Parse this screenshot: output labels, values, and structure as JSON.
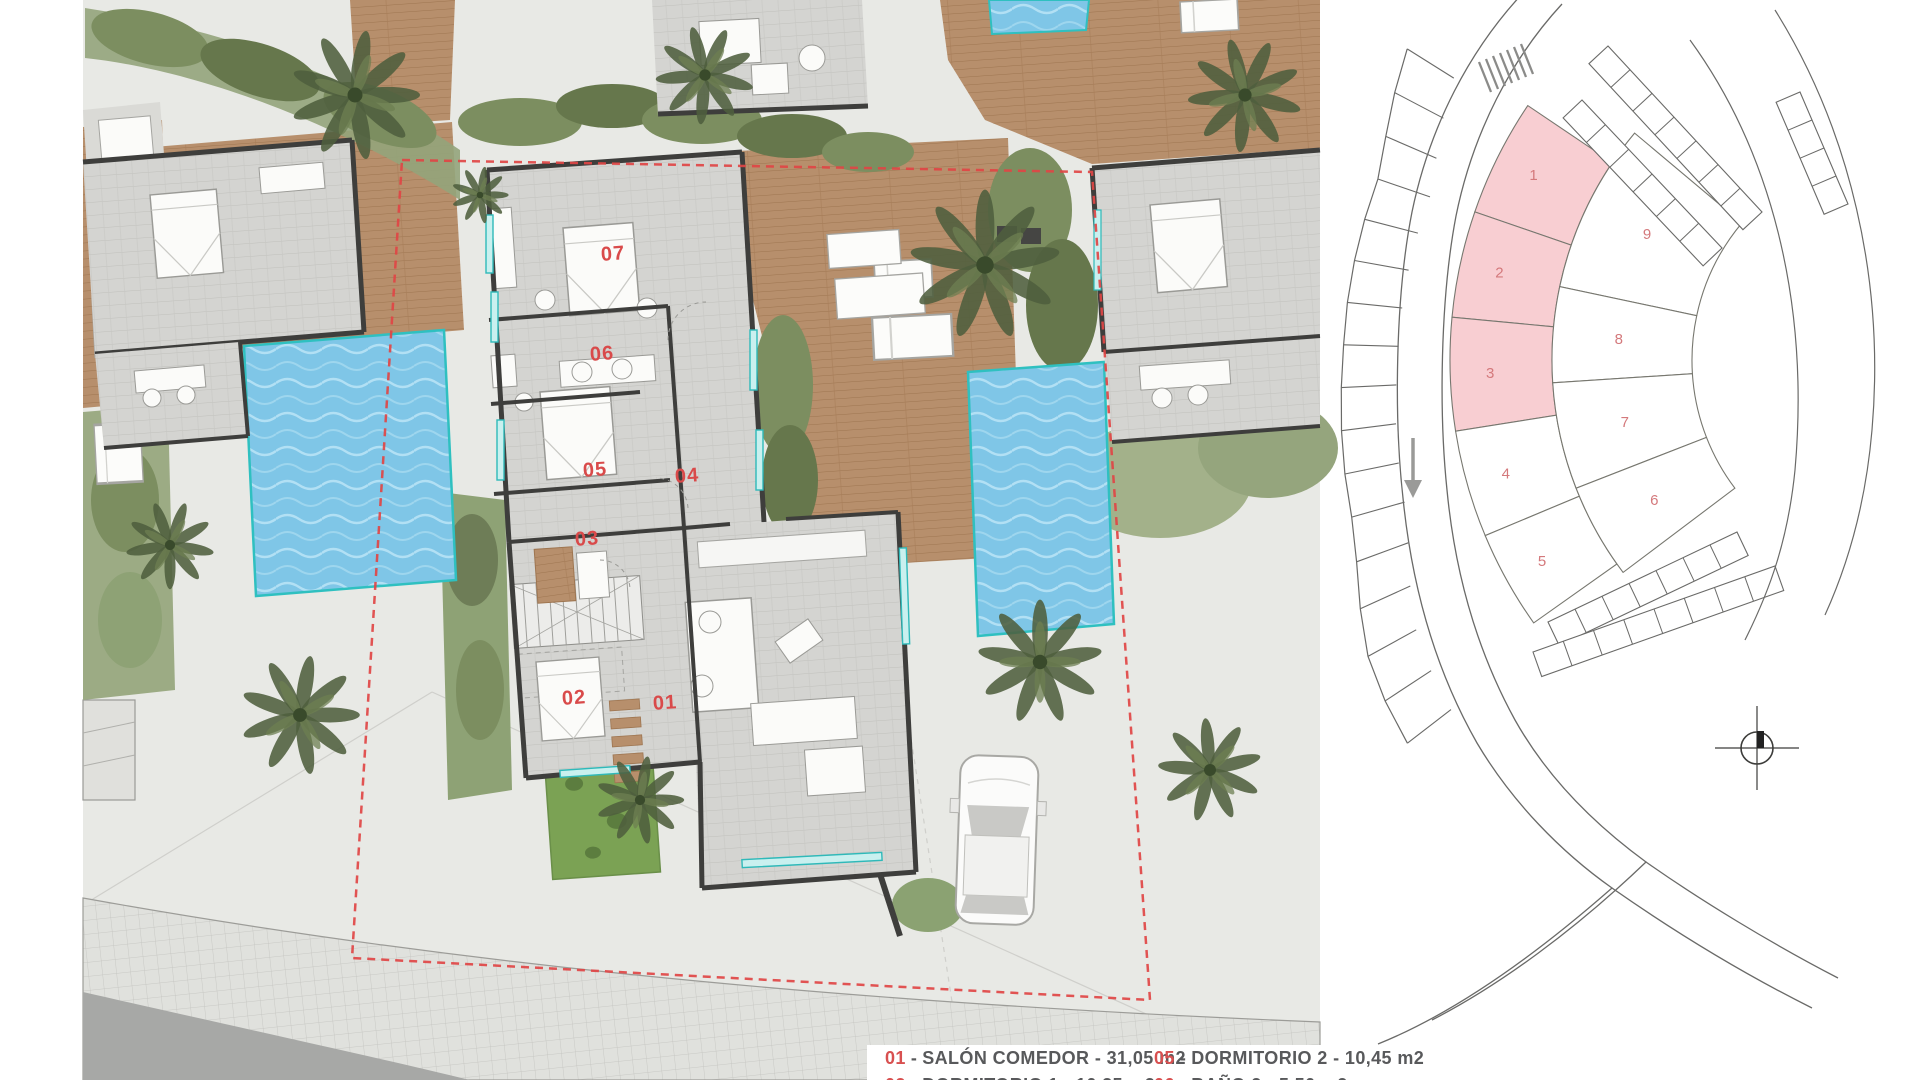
{
  "document": {
    "type": "architectural floor plan with key plan",
    "language": "Spanish"
  },
  "colors": {
    "pool_water": "#7fc6e7",
    "deck_wood": "#b78f6c",
    "walls": "#3e3e3c",
    "vegetation": "#8ea275",
    "plot_boundary_red": "#e04545",
    "room_label_red": "#d94a4a",
    "keyplan_highlight": "#f8ced2",
    "keyplan_number": "#d4797c",
    "legend_number_red": "#d85050",
    "legend_text": "#58595b"
  },
  "floorplan": {
    "label_color": "#d94a4a",
    "rooms": [
      {
        "id": "01"
      },
      {
        "id": "02"
      },
      {
        "id": "03"
      },
      {
        "id": "04"
      },
      {
        "id": "05"
      },
      {
        "id": "06"
      },
      {
        "id": "07"
      }
    ]
  },
  "keyplan": {
    "highlight_color": "#f8ced2",
    "plot_fill": "#ffffff",
    "number_color": "#d4797c",
    "inner_plots": [
      {
        "number": "1",
        "highlighted": true
      },
      {
        "number": "2",
        "highlighted": true
      },
      {
        "number": "3",
        "highlighted": true
      },
      {
        "number": "4",
        "highlighted": false
      },
      {
        "number": "5",
        "highlighted": false
      }
    ],
    "outer_plots": [
      {
        "number": "9",
        "highlighted": false
      },
      {
        "number": "8",
        "highlighted": false
      },
      {
        "number": "7",
        "highlighted": false
      },
      {
        "number": "6",
        "highlighted": false
      }
    ]
  },
  "legend": {
    "separator": "-",
    "items": [
      {
        "num": "01",
        "label": "SALÓN COMEDOR - 31,05 m2",
        "col": 1
      },
      {
        "num": "02",
        "label": "DORMITORIO 1 - 10,35 m2",
        "col": 1
      },
      {
        "num": "05",
        "label": "DORMITORIO 2 - 10,45 m2",
        "col": 2
      },
      {
        "num": "06",
        "label": "BAÑO 2 - 5,50 m2",
        "col": 2
      }
    ]
  }
}
